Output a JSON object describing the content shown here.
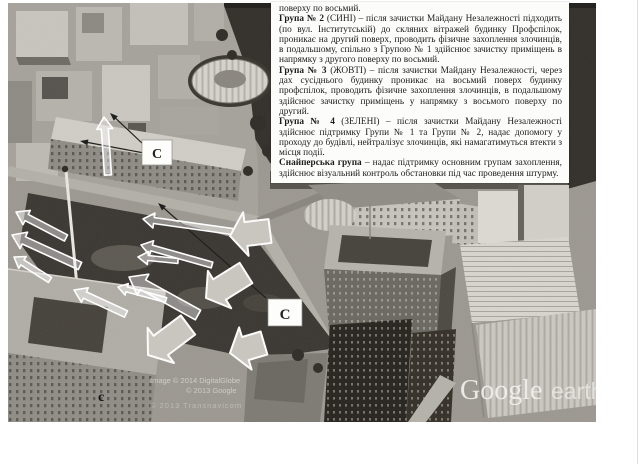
{
  "document": {
    "intro_line": "поверху по восьмий.",
    "groups": [
      {
        "name": "Група № 2",
        "rest": " (СИНІ) – після зачистки Майдану Незалежності підходить (по вул. Інститутській) до скляних вітражей будинку Профспілок, проникає на другий поверх, проводить фізичне захоплення злочинців, в подальшому, спільно з Групою № 1 здійснює зачистку приміщень в напрямку з другого поверху по восьмий."
      },
      {
        "name": "Група № 3",
        "rest": " (ЖОВТІ) – після зачистки Майдану Незалежності, через дах сусіднього будинку проникає на восьмий поверх будинку профспілок, проводить фізичне захоплення злочинців, в подальшому здійснює зачистку приміщень у напрямку з восьмого поверху по другий."
      },
      {
        "name": "Група № 4",
        "rest": " (ЗЕЛЕНІ) – після зачистки Майдану Незалежності здійснює підтримку Групи № 1 та Групи № 2, надає допомогу у проходу до будівлі, нейтралізує злочинців, які намагатимуться втекти з місця події."
      },
      {
        "name": "Снайперська група",
        "rest": " – надає підтримку основним групам захоплення, здійснює візуальний контроль обстановки під час проведення штурму."
      }
    ]
  },
  "map": {
    "sniper_marker_a": "С",
    "sniper_marker_b": "С",
    "sniper_marker_small": "с",
    "credits": [
      "Image © 2014 DigitalGlobe",
      "© 2013 Google",
      "© 2013 Transnavicom"
    ],
    "watermark": {
      "brand": "Google",
      "product": "earth"
    }
  }
}
